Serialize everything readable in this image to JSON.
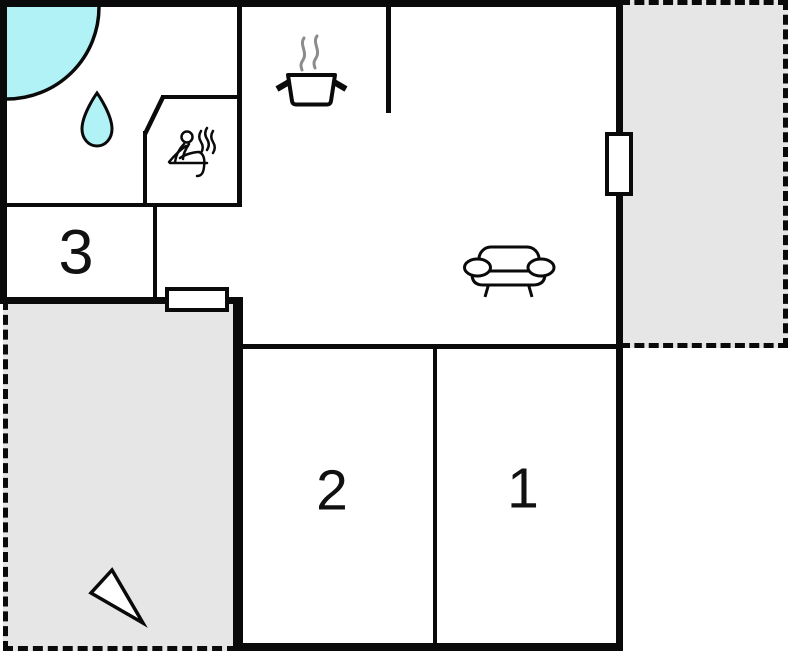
{
  "plan": {
    "rooms": [
      {
        "id": "1",
        "label": "1"
      },
      {
        "id": "2",
        "label": "2"
      },
      {
        "id": "3",
        "label": "3"
      }
    ],
    "fixture_icons": [
      "corner-bathtub-icon",
      "water-drop-icon",
      "sauna-bather-icon",
      "stove-pot-icon",
      "sofa-icon",
      "north-arrow-icon"
    ],
    "openings": [
      "right-wall-window",
      "hallway-exterior-door"
    ],
    "outdoor_areas": [
      "terrace-top-right",
      "terrace-bottom-left"
    ]
  },
  "colors": {
    "wall": "#0a0a0a",
    "water": "#b0f2f5",
    "terrace": "#e6e6e6",
    "steam": "#8c8c8c",
    "background": "#ffffff"
  }
}
